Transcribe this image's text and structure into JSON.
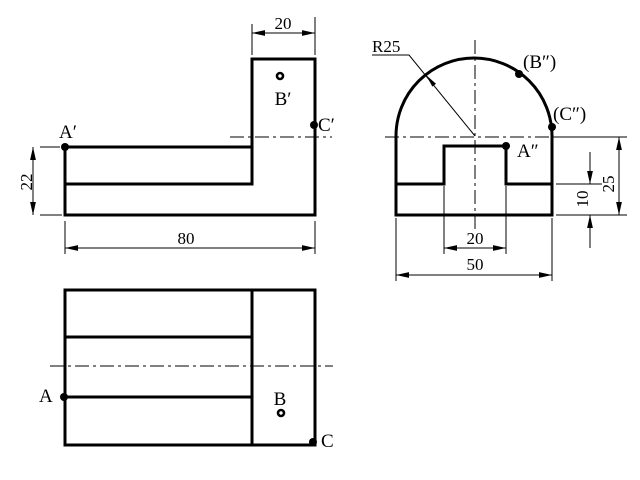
{
  "colors": {
    "line": "#000000",
    "background": "#ffffff"
  },
  "front_view": {
    "points": {
      "a": "A′",
      "b": "B′",
      "c": "C′"
    },
    "dims": {
      "column_width": "20",
      "base_height": "22",
      "total_width": "80"
    }
  },
  "side_view": {
    "points": {
      "a": "A″",
      "b": "(B″)",
      "c": "(C″)"
    },
    "dims": {
      "radius": "R25",
      "notch_width": "20",
      "total_width": "50",
      "upper_height": "25",
      "step_height": "10"
    }
  },
  "top_view": {
    "points": {
      "a": "A",
      "b": "B",
      "c": "C"
    }
  }
}
